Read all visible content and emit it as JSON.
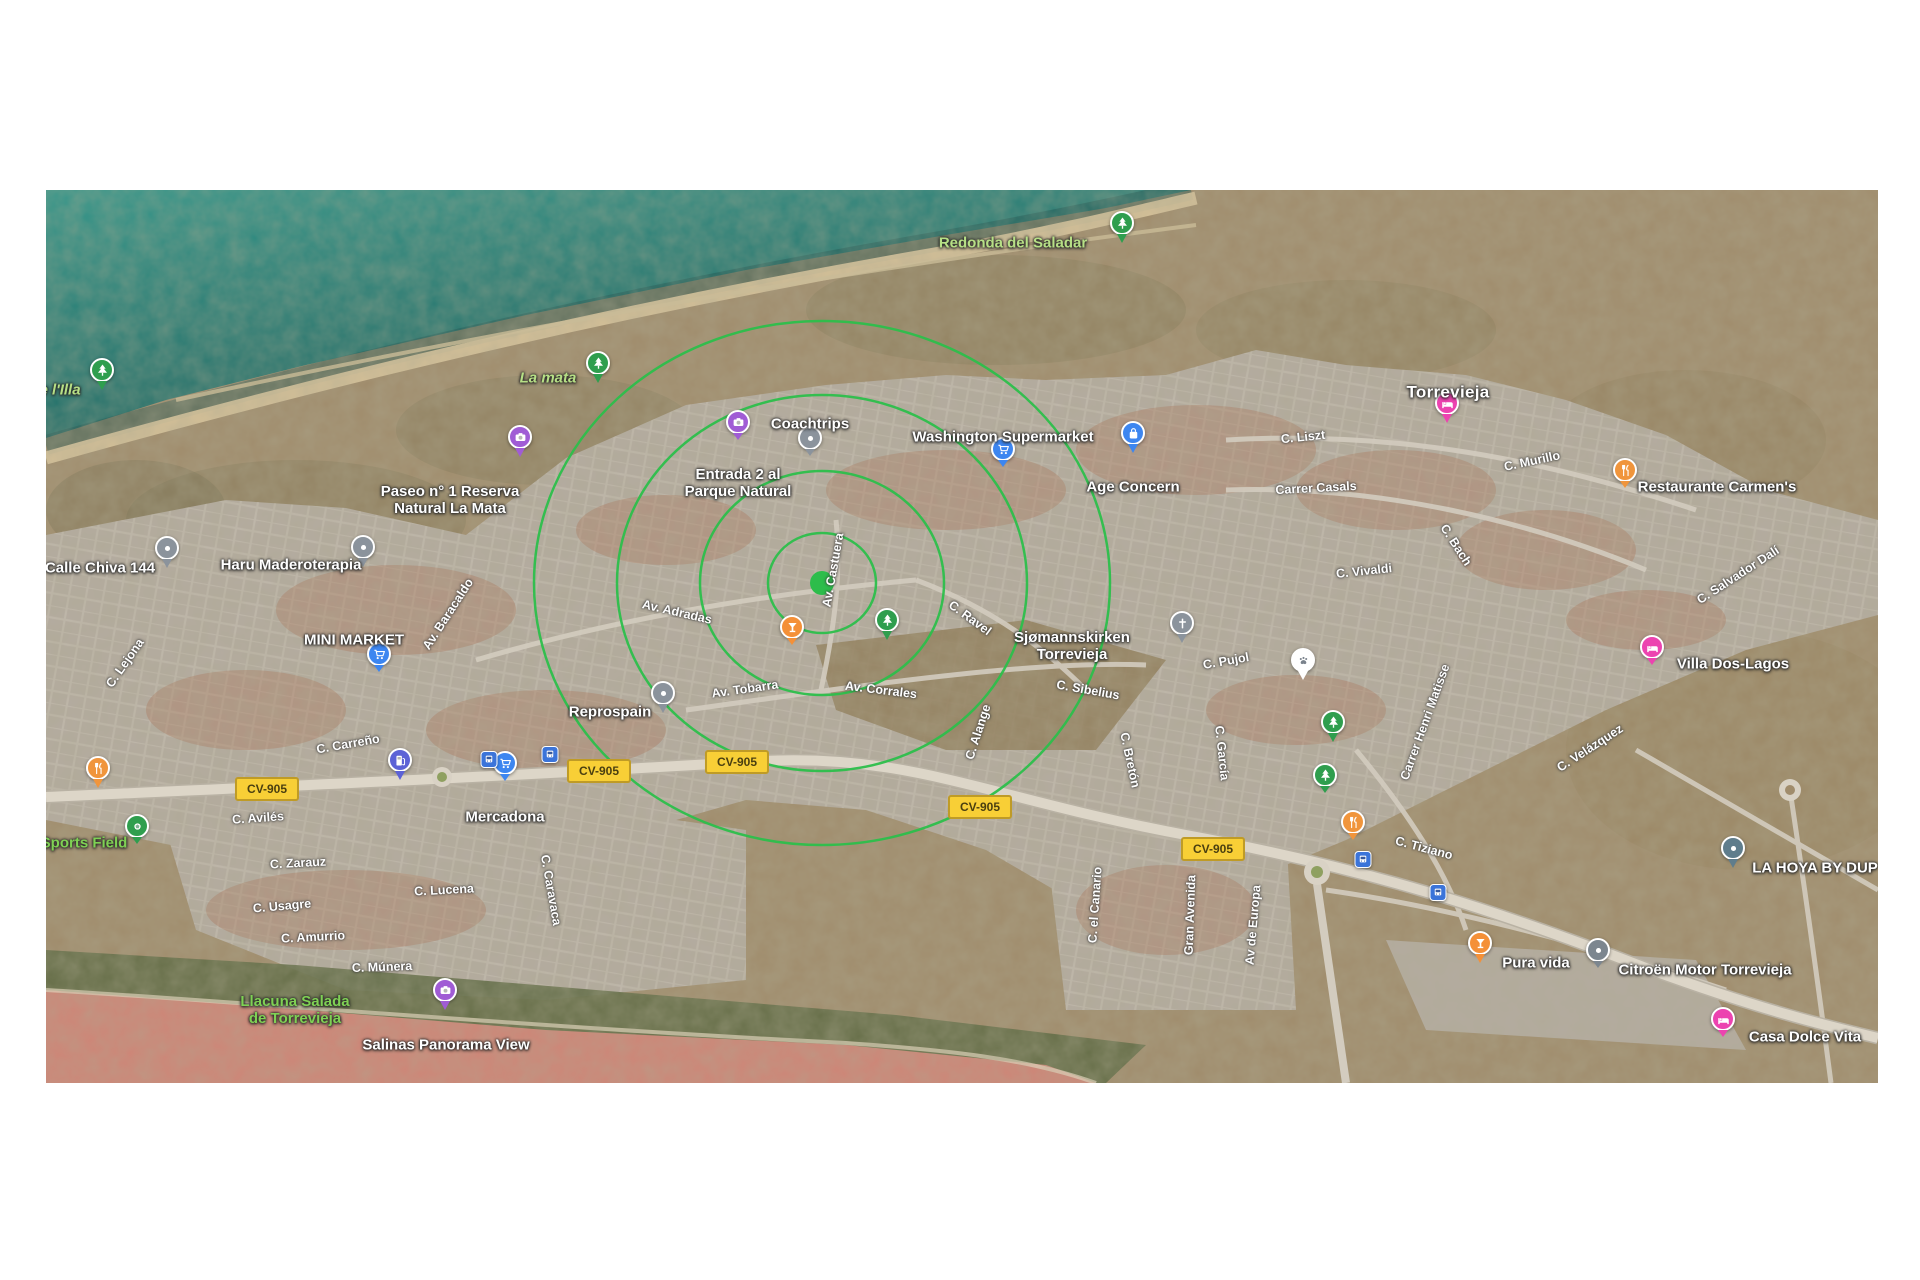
{
  "map": {
    "colors": {
      "sea": "#2e8a7e",
      "sea_deep": "#1c5f5b",
      "sand": "#d8c49c",
      "land": "#a59070",
      "urban": "#b4aba0",
      "terracotta": "#aa6a4d",
      "lagoon": "#cf8476",
      "vegetation": "#5f6a45",
      "road": "#ddd6c8",
      "ring": "#2cbf4b",
      "selection_dot": "#2dbd4b",
      "shield_bg": "#f8cf36",
      "shield_border": "#bf9b26",
      "nature_label": "#b7e086"
    },
    "selection": {
      "x": 776,
      "y": 393,
      "dot_radius": 12,
      "rings": [
        {
          "rx": 54,
          "ry": 50
        },
        {
          "rx": 122,
          "ry": 112
        },
        {
          "rx": 205,
          "ry": 188
        },
        {
          "rx": 288,
          "ry": 262
        }
      ]
    },
    "shields": [
      {
        "text": "CV-905",
        "x": 221,
        "y": 599
      },
      {
        "text": "CV-905",
        "x": 553,
        "y": 581
      },
      {
        "text": "CV-905",
        "x": 691,
        "y": 572
      },
      {
        "text": "CV-905",
        "x": 934,
        "y": 617
      },
      {
        "text": "CV-905",
        "x": 1167,
        "y": 659
      }
    ],
    "labels": [
      {
        "id": "redonda-del-saladar",
        "lines": [
          "Redonda del Saladar"
        ],
        "x": 967,
        "y": 53,
        "cls": "nature"
      },
      {
        "id": "e-l-illa",
        "lines": [
          "e l'Illa"
        ],
        "x": 14,
        "y": 200,
        "cls": "nature italic"
      },
      {
        "id": "la-mata",
        "lines": [
          "La mata"
        ],
        "x": 502,
        "y": 188,
        "cls": "nature italic"
      },
      {
        "id": "coachtrips",
        "lines": [
          "Coachtrips"
        ],
        "x": 764,
        "y": 234,
        "cls": ""
      },
      {
        "id": "washington-supermarket",
        "lines": [
          "Washington Supermarket"
        ],
        "x": 957,
        "y": 247,
        "cls": ""
      },
      {
        "id": "entrada-parque-natural",
        "lines": [
          "Entrada 2 al",
          "Parque Natural"
        ],
        "x": 692,
        "y": 293,
        "cls": ""
      },
      {
        "id": "paseo-reserva",
        "lines": [
          "Paseo n° 1 Reserva",
          "Natural La Mata"
        ],
        "x": 404,
        "y": 310,
        "cls": ""
      },
      {
        "id": "age-concern",
        "lines": [
          "Age Concern"
        ],
        "x": 1087,
        "y": 297,
        "cls": ""
      },
      {
        "id": "torrevieja-city",
        "lines": [
          "Torrevieja"
        ],
        "x": 1402,
        "y": 202,
        "cls": "city"
      },
      {
        "id": "restaurante-carmens",
        "lines": [
          "Restaurante Carmen's"
        ],
        "x": 1671,
        "y": 297,
        "cls": ""
      },
      {
        "id": "calle-chiva-144",
        "lines": [
          "Calle Chiva 144"
        ],
        "x": 54,
        "y": 378,
        "cls": ""
      },
      {
        "id": "haru-maderoterapia",
        "lines": [
          "Haru Maderoterapia"
        ],
        "x": 245,
        "y": 375,
        "cls": ""
      },
      {
        "id": "mini-market",
        "lines": [
          "MINI MARKET"
        ],
        "x": 308,
        "y": 450,
        "cls": ""
      },
      {
        "id": "sjomannskirken",
        "lines": [
          "Sjømannskirken",
          "Torrevieja"
        ],
        "x": 1026,
        "y": 456,
        "cls": ""
      },
      {
        "id": "villa-dos-lagos",
        "lines": [
          "Villa Dos-Lagos"
        ],
        "x": 1687,
        "y": 474,
        "cls": ""
      },
      {
        "id": "reprospain",
        "lines": [
          "Reprospain"
        ],
        "x": 564,
        "y": 522,
        "cls": ""
      },
      {
        "id": "mercadona",
        "lines": [
          "Mercadona"
        ],
        "x": 459,
        "y": 627,
        "cls": ""
      },
      {
        "id": "sports-field",
        "lines": [
          "Sports Field"
        ],
        "x": 38,
        "y": 653,
        "cls": "nature-bright"
      },
      {
        "id": "la-hoya",
        "lines": [
          "LA HOYA BY DUP"
        ],
        "x": 1769,
        "y": 678,
        "cls": ""
      },
      {
        "id": "pura-vida",
        "lines": [
          "Pura vida"
        ],
        "x": 1490,
        "y": 773,
        "cls": ""
      },
      {
        "id": "citroen-motor",
        "lines": [
          "Citroën Motor Torrevieja"
        ],
        "x": 1659,
        "y": 780,
        "cls": ""
      },
      {
        "id": "casa-dolce-vita",
        "lines": [
          "Casa Dolce Vita"
        ],
        "x": 1759,
        "y": 847,
        "cls": ""
      },
      {
        "id": "salinas-panorama-view",
        "lines": [
          "Salinas Panorama View"
        ],
        "x": 400,
        "y": 855,
        "cls": ""
      },
      {
        "id": "llacuna-salada",
        "lines": [
          "Llacuna Salada",
          "de Torrevieja"
        ],
        "x": 249,
        "y": 820,
        "cls": "nature-bright"
      }
    ],
    "markers": [
      {
        "icon": "tree",
        "shape": "pin",
        "color": "#2f9e4e",
        "x": 1076,
        "y": 53
      },
      {
        "icon": "tree",
        "shape": "pin",
        "color": "#2f9e4e",
        "x": 56,
        "y": 200
      },
      {
        "icon": "tree",
        "shape": "pin",
        "color": "#2f9e4e",
        "x": 552,
        "y": 193
      },
      {
        "icon": "tree",
        "shape": "pin",
        "color": "#2f9e4e",
        "x": 841,
        "y": 450
      },
      {
        "icon": "tree",
        "shape": "pin",
        "color": "#2f9e4e",
        "x": 1287,
        "y": 552
      },
      {
        "icon": "tree",
        "shape": "circle",
        "color": "#2f9e4e",
        "x": 1279,
        "y": 603
      },
      {
        "icon": "camera",
        "shape": "circle",
        "color": "#a05cd5",
        "x": 692,
        "y": 250
      },
      {
        "icon": "camera",
        "shape": "pin",
        "color": "#a05cd5",
        "x": 474,
        "y": 267
      },
      {
        "icon": "camera",
        "shape": "pin",
        "color": "#a05cd5",
        "x": 399,
        "y": 820
      },
      {
        "icon": "dot",
        "shape": "circle",
        "color": "#8b939c",
        "x": 764,
        "y": 266
      },
      {
        "icon": "dot",
        "shape": "pin",
        "color": "#8b939c",
        "x": 121,
        "y": 378
      },
      {
        "icon": "dot",
        "shape": "pin",
        "color": "#8b939c",
        "x": 317,
        "y": 377
      },
      {
        "icon": "dot",
        "shape": "pin",
        "color": "#8b939c",
        "x": 617,
        "y": 523
      },
      {
        "icon": "dot",
        "shape": "pin",
        "color": "#5f7d8c",
        "x": 1687,
        "y": 678
      },
      {
        "icon": "dot",
        "shape": "circle",
        "color": "#7c868f",
        "x": 1552,
        "y": 778
      },
      {
        "icon": "cart",
        "shape": "circle",
        "color": "#3d86f0",
        "x": 957,
        "y": 277
      },
      {
        "icon": "cart",
        "shape": "circle",
        "color": "#3d86f0",
        "x": 333,
        "y": 482
      },
      {
        "icon": "cart",
        "shape": "circle",
        "color": "#3d86f0",
        "x": 459,
        "y": 591
      },
      {
        "icon": "bag",
        "shape": "pin",
        "color": "#3d86f0",
        "x": 1087,
        "y": 263
      },
      {
        "icon": "bed",
        "shape": "pin",
        "color": "#ec43b0",
        "x": 1401,
        "y": 233
      },
      {
        "icon": "bed",
        "shape": "circle",
        "color": "#ec43b0",
        "x": 1606,
        "y": 475
      },
      {
        "icon": "bed",
        "shape": "circle",
        "color": "#ec43b0",
        "x": 1677,
        "y": 847
      },
      {
        "icon": "restaurant",
        "shape": "circle",
        "color": "#f0953c",
        "x": 1579,
        "y": 298
      },
      {
        "icon": "restaurant",
        "shape": "circle",
        "color": "#f0953c",
        "x": 1307,
        "y": 650
      },
      {
        "icon": "restaurant",
        "shape": "pin",
        "color": "#f0953c",
        "x": 52,
        "y": 598
      },
      {
        "icon": "bar",
        "shape": "circle",
        "color": "#f49038",
        "x": 746,
        "y": 455
      },
      {
        "icon": "bar",
        "shape": "pin",
        "color": "#f49038",
        "x": 1434,
        "y": 773
      },
      {
        "icon": "church",
        "shape": "pin",
        "color": "#8b939c",
        "x": 1136,
        "y": 453
      },
      {
        "icon": "paw",
        "shape": "pin",
        "color": "#ffffff",
        "glyph": "#7a828c",
        "x": 1257,
        "y": 490
      },
      {
        "icon": "ball",
        "shape": "circle",
        "color": "#2f9e4e",
        "x": 91,
        "y": 654
      },
      {
        "icon": "fuel",
        "shape": "pin",
        "color": "#5c62d6",
        "x": 354,
        "y": 590
      },
      {
        "icon": "bus",
        "shape": "square",
        "color": "#3b74d9",
        "x": 443,
        "y": 578
      },
      {
        "icon": "bus",
        "shape": "square",
        "color": "#3b74d9",
        "x": 504,
        "y": 573
      },
      {
        "icon": "bus",
        "shape": "square",
        "color": "#3b74d9",
        "x": 1317,
        "y": 678
      },
      {
        "icon": "bus",
        "shape": "square",
        "color": "#3b74d9",
        "x": 1392,
        "y": 711
      }
    ],
    "road_labels": [
      {
        "text": "C. Liszt",
        "x": 1257,
        "y": 247,
        "angle": -6
      },
      {
        "text": "Carrer Casals",
        "x": 1270,
        "y": 298,
        "angle": -3
      },
      {
        "text": "C. Murillo",
        "x": 1486,
        "y": 271,
        "angle": -12
      },
      {
        "text": "C. Bach",
        "x": 1410,
        "y": 355,
        "angle": 57
      },
      {
        "text": "C. Vivaldi",
        "x": 1318,
        "y": 381,
        "angle": -6
      },
      {
        "text": "C. Salvador Dalí",
        "x": 1692,
        "y": 385,
        "angle": -33
      },
      {
        "text": "Av. Baracaldo",
        "x": 402,
        "y": 424,
        "angle": -57
      },
      {
        "text": "C. Lejona",
        "x": 79,
        "y": 473,
        "angle": -55
      },
      {
        "text": "Av. Adradas",
        "x": 631,
        "y": 422,
        "angle": 13
      },
      {
        "text": "Av. Castuera",
        "x": 787,
        "y": 380,
        "angle": -80
      },
      {
        "text": "C. Ravel",
        "x": 924,
        "y": 428,
        "angle": 36
      },
      {
        "text": "Av. Tobarra",
        "x": 699,
        "y": 499,
        "angle": -8
      },
      {
        "text": "Av. Corrales",
        "x": 835,
        "y": 500,
        "angle": 7
      },
      {
        "text": "C. Sibelius",
        "x": 1042,
        "y": 500,
        "angle": 10
      },
      {
        "text": "C. Alange",
        "x": 932,
        "y": 542,
        "angle": -72
      },
      {
        "text": "C. Bretón",
        "x": 1084,
        "y": 570,
        "angle": 78
      },
      {
        "text": "C. García",
        "x": 1176,
        "y": 563,
        "angle": 84
      },
      {
        "text": "C. Pujol",
        "x": 1180,
        "y": 471,
        "angle": -10
      },
      {
        "text": "Carrer Henri Matisse",
        "x": 1379,
        "y": 532,
        "angle": -70
      },
      {
        "text": "C. Velázquez",
        "x": 1544,
        "y": 558,
        "angle": -33
      },
      {
        "text": "C. Tiziano",
        "x": 1378,
        "y": 658,
        "angle": 15
      },
      {
        "text": "C. Carreño",
        "x": 302,
        "y": 554,
        "angle": -10
      },
      {
        "text": "C. Avilés",
        "x": 212,
        "y": 628,
        "angle": -4
      },
      {
        "text": "C. Zarauz",
        "x": 252,
        "y": 673,
        "angle": -3
      },
      {
        "text": "C. Usagre",
        "x": 236,
        "y": 716,
        "angle": -5
      },
      {
        "text": "C. Lucena",
        "x": 398,
        "y": 700,
        "angle": -3
      },
      {
        "text": "C. Amurrio",
        "x": 267,
        "y": 747,
        "angle": -3
      },
      {
        "text": "C. Múnera",
        "x": 336,
        "y": 777,
        "angle": -2
      },
      {
        "text": "C. Caravaca",
        "x": 505,
        "y": 700,
        "angle": 80
      },
      {
        "text": "C. el Canario",
        "x": 1049,
        "y": 715,
        "angle": -86
      },
      {
        "text": "Gran Avenida",
        "x": 1144,
        "y": 725,
        "angle": -88
      },
      {
        "text": "Av de Europa",
        "x": 1207,
        "y": 735,
        "angle": -85
      }
    ]
  }
}
